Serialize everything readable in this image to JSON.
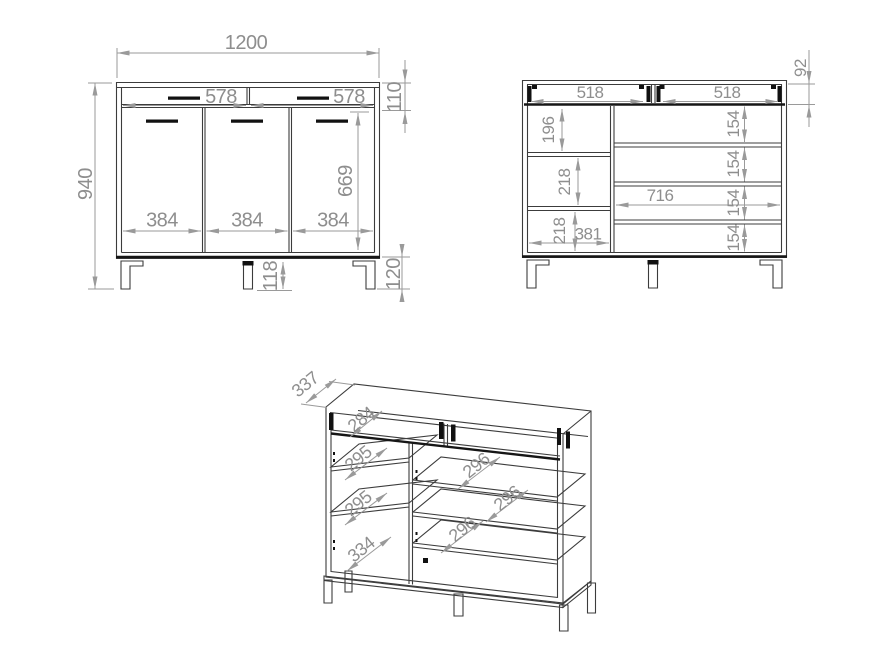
{
  "drawing": {
    "type": "furniture technical drawing",
    "views": {
      "front": {
        "dims": {
          "overall_width": "1200",
          "overall_height": "940",
          "drawer_front_widths": [
            "578",
            "578"
          ],
          "drawer_row_height": "110",
          "door_height": "669",
          "door_widths": [
            "384",
            "384",
            "384"
          ],
          "center_leg_height": "118",
          "leg_height": "120"
        }
      },
      "internal": {
        "dims": {
          "drawer_inner_height": "92",
          "drawer_inner_widths": [
            "518",
            "518"
          ],
          "left_compartment_heights": [
            "196",
            "218",
            "218"
          ],
          "left_compartment_width": "381",
          "right_compartment_width": "716",
          "shelf_gap_heights": [
            "154",
            "154",
            "154",
            "154"
          ]
        }
      },
      "iso": {
        "dims": {
          "depth": "337",
          "drawer_inner_depth": "284",
          "left_shelf_depths": [
            "295",
            "295"
          ],
          "left_bottom_depth": "334",
          "right_shelf_depths": [
            "296",
            "296",
            "296"
          ]
        }
      }
    },
    "style": {
      "line_color": "#3c3c3c",
      "dim_color": "#9a9a9a",
      "background": "#ffffff"
    }
  }
}
